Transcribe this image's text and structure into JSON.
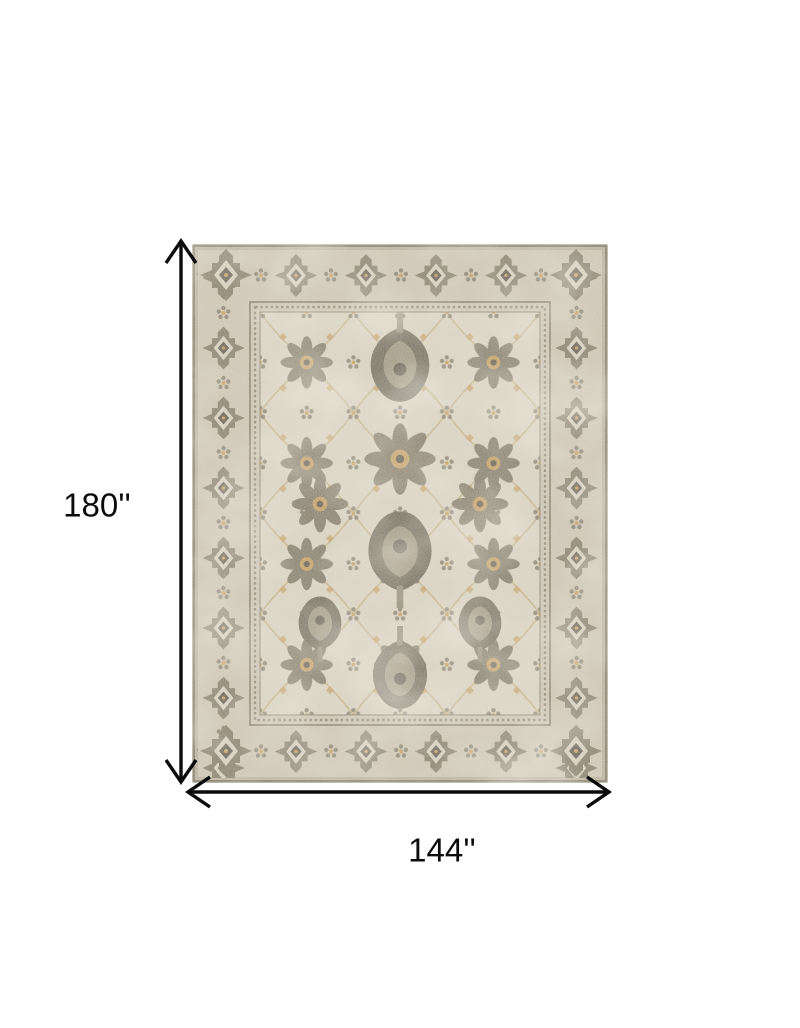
{
  "page": {
    "background": "#ffffff"
  },
  "diagram": {
    "type": "product-dimensions",
    "height": {
      "value": 180,
      "unit_mark": "''",
      "label": "180''"
    },
    "width": {
      "value": 144,
      "unit_mark": "''",
      "label": "144''"
    }
  },
  "rug": {
    "style": "distressed-oriental-medallion-rug"
  },
  "colors": {
    "arrow": "#0b0b0b",
    "dimension_text": "#0b0b0b",
    "rug_border_ground": "#cdc5b4",
    "rug_field": "#d9d2c2",
    "rug_motif_gray": "#857d6c",
    "rug_motif_dark": "#6b6457",
    "rug_motif_tan": "#c4a26a"
  }
}
